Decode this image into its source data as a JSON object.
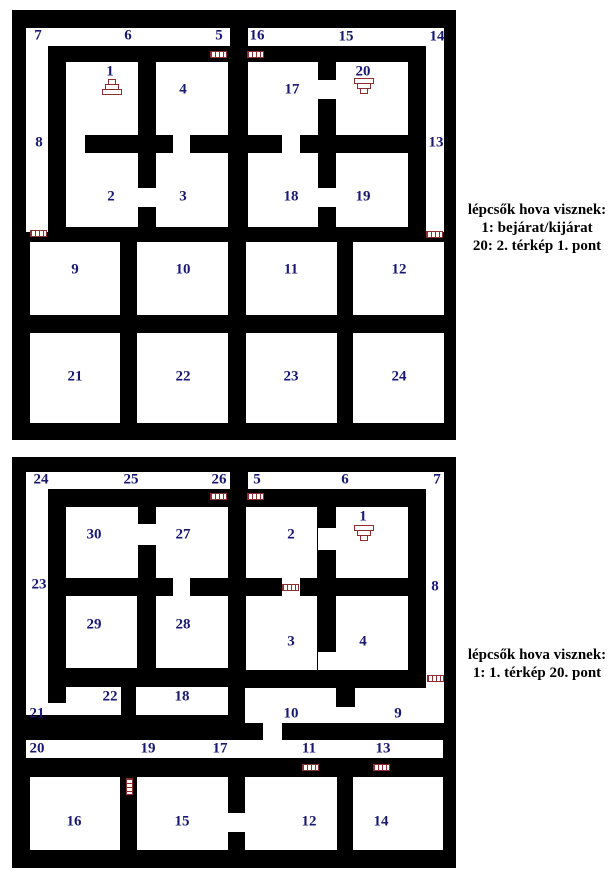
{
  "page": {
    "width": 608,
    "height": 880,
    "background": "#ffffff"
  },
  "colors": {
    "wall": "#000000",
    "floor": "#ffffff",
    "room_label": "#191970",
    "icon_accent": "#8b2f2f",
    "legend_text": "#000000"
  },
  "maps": [
    {
      "id": "map-1",
      "frame": [
        12,
        10,
        444,
        430
      ],
      "floors": [
        [
          26,
          28,
          204,
          18
        ],
        [
          248,
          28,
          196,
          18
        ],
        [
          26,
          28,
          22,
          204
        ],
        [
          426,
          28,
          18,
          204
        ],
        [
          66,
          62,
          72,
          73
        ],
        [
          156,
          62,
          72,
          73
        ],
        [
          248,
          62,
          70,
          73
        ],
        [
          336,
          62,
          72,
          73
        ],
        [
          66,
          135,
          19,
          18
        ],
        [
          173,
          135,
          17,
          18
        ],
        [
          282,
          135,
          18,
          18
        ],
        [
          318,
          80,
          18,
          19
        ],
        [
          66,
          153,
          72,
          74
        ],
        [
          156,
          153,
          72,
          74
        ],
        [
          248,
          153,
          70,
          74
        ],
        [
          336,
          153,
          72,
          74
        ],
        [
          138,
          188,
          18,
          19
        ],
        [
          318,
          188,
          18,
          19
        ],
        [
          30,
          242,
          90,
          73
        ],
        [
          137,
          242,
          91,
          73
        ],
        [
          246,
          242,
          91,
          73
        ],
        [
          353,
          242,
          91,
          73
        ],
        [
          30,
          333,
          90,
          90
        ],
        [
          137,
          333,
          91,
          90
        ],
        [
          246,
          333,
          91,
          90
        ],
        [
          353,
          333,
          91,
          90
        ]
      ],
      "rooms": [
        {
          "label": "7",
          "x": 38,
          "y": 36
        },
        {
          "label": "6",
          "x": 128,
          "y": 36
        },
        {
          "label": "5",
          "x": 219,
          "y": 36
        },
        {
          "label": "16",
          "x": 257,
          "y": 36
        },
        {
          "label": "15",
          "x": 346,
          "y": 37
        },
        {
          "label": "14",
          "x": 437,
          "y": 37
        },
        {
          "label": "8",
          "x": 39,
          "y": 143
        },
        {
          "label": "13",
          "x": 436,
          "y": 143
        },
        {
          "label": "1",
          "x": 110,
          "y": 72
        },
        {
          "label": "4",
          "x": 183,
          "y": 90
        },
        {
          "label": "17",
          "x": 292,
          "y": 90
        },
        {
          "label": "20",
          "x": 363,
          "y": 72
        },
        {
          "label": "2",
          "x": 111,
          "y": 197
        },
        {
          "label": "3",
          "x": 183,
          "y": 197
        },
        {
          "label": "18",
          "x": 291,
          "y": 197
        },
        {
          "label": "19",
          "x": 363,
          "y": 197
        },
        {
          "label": "9",
          "x": 75,
          "y": 270
        },
        {
          "label": "10",
          "x": 183,
          "y": 270
        },
        {
          "label": "11",
          "x": 291,
          "y": 270
        },
        {
          "label": "12",
          "x": 399,
          "y": 270
        },
        {
          "label": "21",
          "x": 75,
          "y": 377
        },
        {
          "label": "22",
          "x": 183,
          "y": 377
        },
        {
          "label": "23",
          "x": 291,
          "y": 377
        },
        {
          "label": "24",
          "x": 399,
          "y": 377
        }
      ],
      "icons": [
        {
          "name": "door-icon",
          "type": "door-h",
          "x": 210,
          "y": 51
        },
        {
          "name": "door-icon",
          "type": "door-h",
          "x": 247,
          "y": 51
        },
        {
          "name": "door-icon",
          "type": "door-h",
          "x": 30,
          "y": 230
        },
        {
          "name": "door-icon",
          "type": "door-h",
          "x": 426,
          "y": 231
        },
        {
          "name": "stairs-up-icon",
          "type": "stairs-up",
          "x": 102,
          "y": 80
        },
        {
          "name": "stairs-down-icon",
          "type": "stairs-down",
          "x": 354,
          "y": 79
        }
      ],
      "legend": {
        "x": 462,
        "y": 201,
        "lines": [
          "lépcsők hova visznek:",
          "1: bejárat/kijárat",
          "20: 2. térkép 1. pont"
        ]
      }
    },
    {
      "id": "map-2",
      "frame": [
        12,
        457,
        444,
        411
      ],
      "floors": [
        [
          26,
          472,
          204,
          17
        ],
        [
          248,
          472,
          196,
          17
        ],
        [
          26,
          472,
          22,
          243
        ],
        [
          426,
          472,
          18,
          251
        ],
        [
          66,
          507,
          72,
          71
        ],
        [
          156,
          507,
          72,
          71
        ],
        [
          246,
          507,
          71,
          71
        ],
        [
          336,
          507,
          72,
          71
        ],
        [
          138,
          524,
          18,
          21
        ],
        [
          318,
          528,
          18,
          22
        ],
        [
          173,
          578,
          17,
          18
        ],
        [
          282,
          578,
          18,
          18
        ],
        [
          66,
          596,
          71,
          72
        ],
        [
          156,
          596,
          72,
          72
        ],
        [
          246,
          596,
          71,
          74
        ],
        [
          336,
          596,
          72,
          74
        ],
        [
          318,
          652,
          18,
          18
        ],
        [
          66,
          687,
          55,
          28
        ],
        [
          48,
          703,
          18,
          12
        ],
        [
          136,
          687,
          92,
          28
        ],
        [
          245,
          707,
          198,
          16
        ],
        [
          245,
          688,
          91,
          19
        ],
        [
          355,
          688,
          88,
          19
        ],
        [
          263,
          723,
          19,
          17
        ],
        [
          26,
          740,
          417,
          18
        ],
        [
          30,
          777,
          90,
          73
        ],
        [
          137,
          777,
          91,
          73
        ],
        [
          245,
          777,
          92,
          73
        ],
        [
          353,
          777,
          90,
          73
        ],
        [
          228,
          813,
          17,
          19
        ]
      ],
      "rooms": [
        {
          "label": "24",
          "x": 41,
          "y": 480
        },
        {
          "label": "25",
          "x": 131,
          "y": 480
        },
        {
          "label": "26",
          "x": 219,
          "y": 480
        },
        {
          "label": "5",
          "x": 257,
          "y": 480
        },
        {
          "label": "6",
          "x": 345,
          "y": 480
        },
        {
          "label": "7",
          "x": 437,
          "y": 480
        },
        {
          "label": "23",
          "x": 39,
          "y": 585
        },
        {
          "label": "8",
          "x": 435,
          "y": 587
        },
        {
          "label": "30",
          "x": 94,
          "y": 535
        },
        {
          "label": "27",
          "x": 183,
          "y": 535
        },
        {
          "label": "2",
          "x": 291,
          "y": 535
        },
        {
          "label": "1",
          "x": 363,
          "y": 517
        },
        {
          "label": "29",
          "x": 94,
          "y": 625
        },
        {
          "label": "28",
          "x": 183,
          "y": 625
        },
        {
          "label": "3",
          "x": 291,
          "y": 642
        },
        {
          "label": "4",
          "x": 363,
          "y": 642
        },
        {
          "label": "22",
          "x": 110,
          "y": 697
        },
        {
          "label": "18",
          "x": 182,
          "y": 697
        },
        {
          "label": "21",
          "x": 37,
          "y": 714
        },
        {
          "label": "10",
          "x": 291,
          "y": 714
        },
        {
          "label": "9",
          "x": 398,
          "y": 714
        },
        {
          "label": "20",
          "x": 37,
          "y": 749
        },
        {
          "label": "19",
          "x": 148,
          "y": 749
        },
        {
          "label": "17",
          "x": 220,
          "y": 749
        },
        {
          "label": "11",
          "x": 309,
          "y": 749
        },
        {
          "label": "13",
          "x": 383,
          "y": 749
        },
        {
          "label": "16",
          "x": 74,
          "y": 822
        },
        {
          "label": "15",
          "x": 182,
          "y": 822
        },
        {
          "label": "12",
          "x": 309,
          "y": 822
        },
        {
          "label": "14",
          "x": 381,
          "y": 822
        }
      ],
      "icons": [
        {
          "name": "door-icon",
          "type": "door-h",
          "x": 210,
          "y": 493
        },
        {
          "name": "door-icon",
          "type": "door-h",
          "x": 247,
          "y": 493
        },
        {
          "name": "door-icon",
          "type": "door-h",
          "x": 282,
          "y": 584
        },
        {
          "name": "door-icon",
          "type": "door-h",
          "x": 427,
          "y": 675
        },
        {
          "name": "door-icon",
          "type": "door-h",
          "x": 302,
          "y": 764
        },
        {
          "name": "door-icon",
          "type": "door-h",
          "x": 373,
          "y": 764
        },
        {
          "name": "door-icon",
          "type": "door-v",
          "x": 126,
          "y": 778
        },
        {
          "name": "stairs-down-icon",
          "type": "stairs-down",
          "x": 354,
          "y": 526
        }
      ],
      "legend": {
        "x": 462,
        "y": 646,
        "lines": [
          "lépcsők hova visznek:",
          "1: 1. térkép 20. pont"
        ]
      }
    }
  ]
}
